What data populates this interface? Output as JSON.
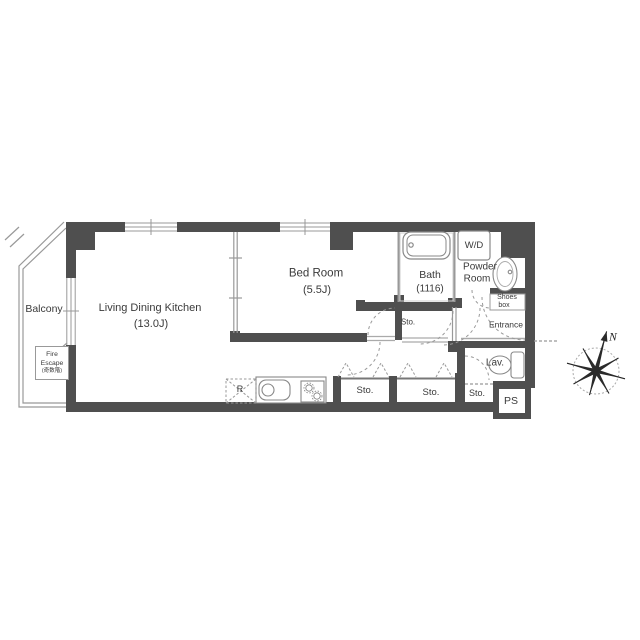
{
  "floor_plan": {
    "colors": {
      "wall": "#4f4f4f",
      "line": "#999999",
      "fixture_line": "#888888",
      "text": "#3a3a3a"
    },
    "rooms": {
      "living_dining_kitchen": {
        "name": "Living Dining Kitchen",
        "size": "(13.0J)"
      },
      "bedroom": {
        "name": "Bed Room",
        "size": "(5.5J)"
      },
      "bath": {
        "name": "Bath",
        "size": "(1116)"
      },
      "washer_dryer": {
        "label": "W/D"
      },
      "powder_room": {
        "name_line1": "Powder",
        "name_line2": "Room"
      },
      "entrance": {
        "label": "Entrance"
      },
      "lavatory": {
        "label": "Lav."
      },
      "balcony": {
        "label": "Balcony"
      },
      "pipe_space": {
        "label": "PS"
      },
      "storage_hall": {
        "label": "Sto."
      },
      "storage_closet_1": {
        "label": "Sto."
      },
      "storage_closet_2": {
        "label": "Sto."
      },
      "storage_closet_3": {
        "label": "Sto."
      }
    },
    "fixtures": {
      "shoes_box": {
        "line1": "Shoes",
        "line2": "box"
      },
      "refrigerator": {
        "label": "R"
      },
      "fire_escape": {
        "line1": "Fire",
        "line2": "Escape",
        "line3": "(奇数階)"
      }
    },
    "compass": {
      "north": "N"
    }
  }
}
